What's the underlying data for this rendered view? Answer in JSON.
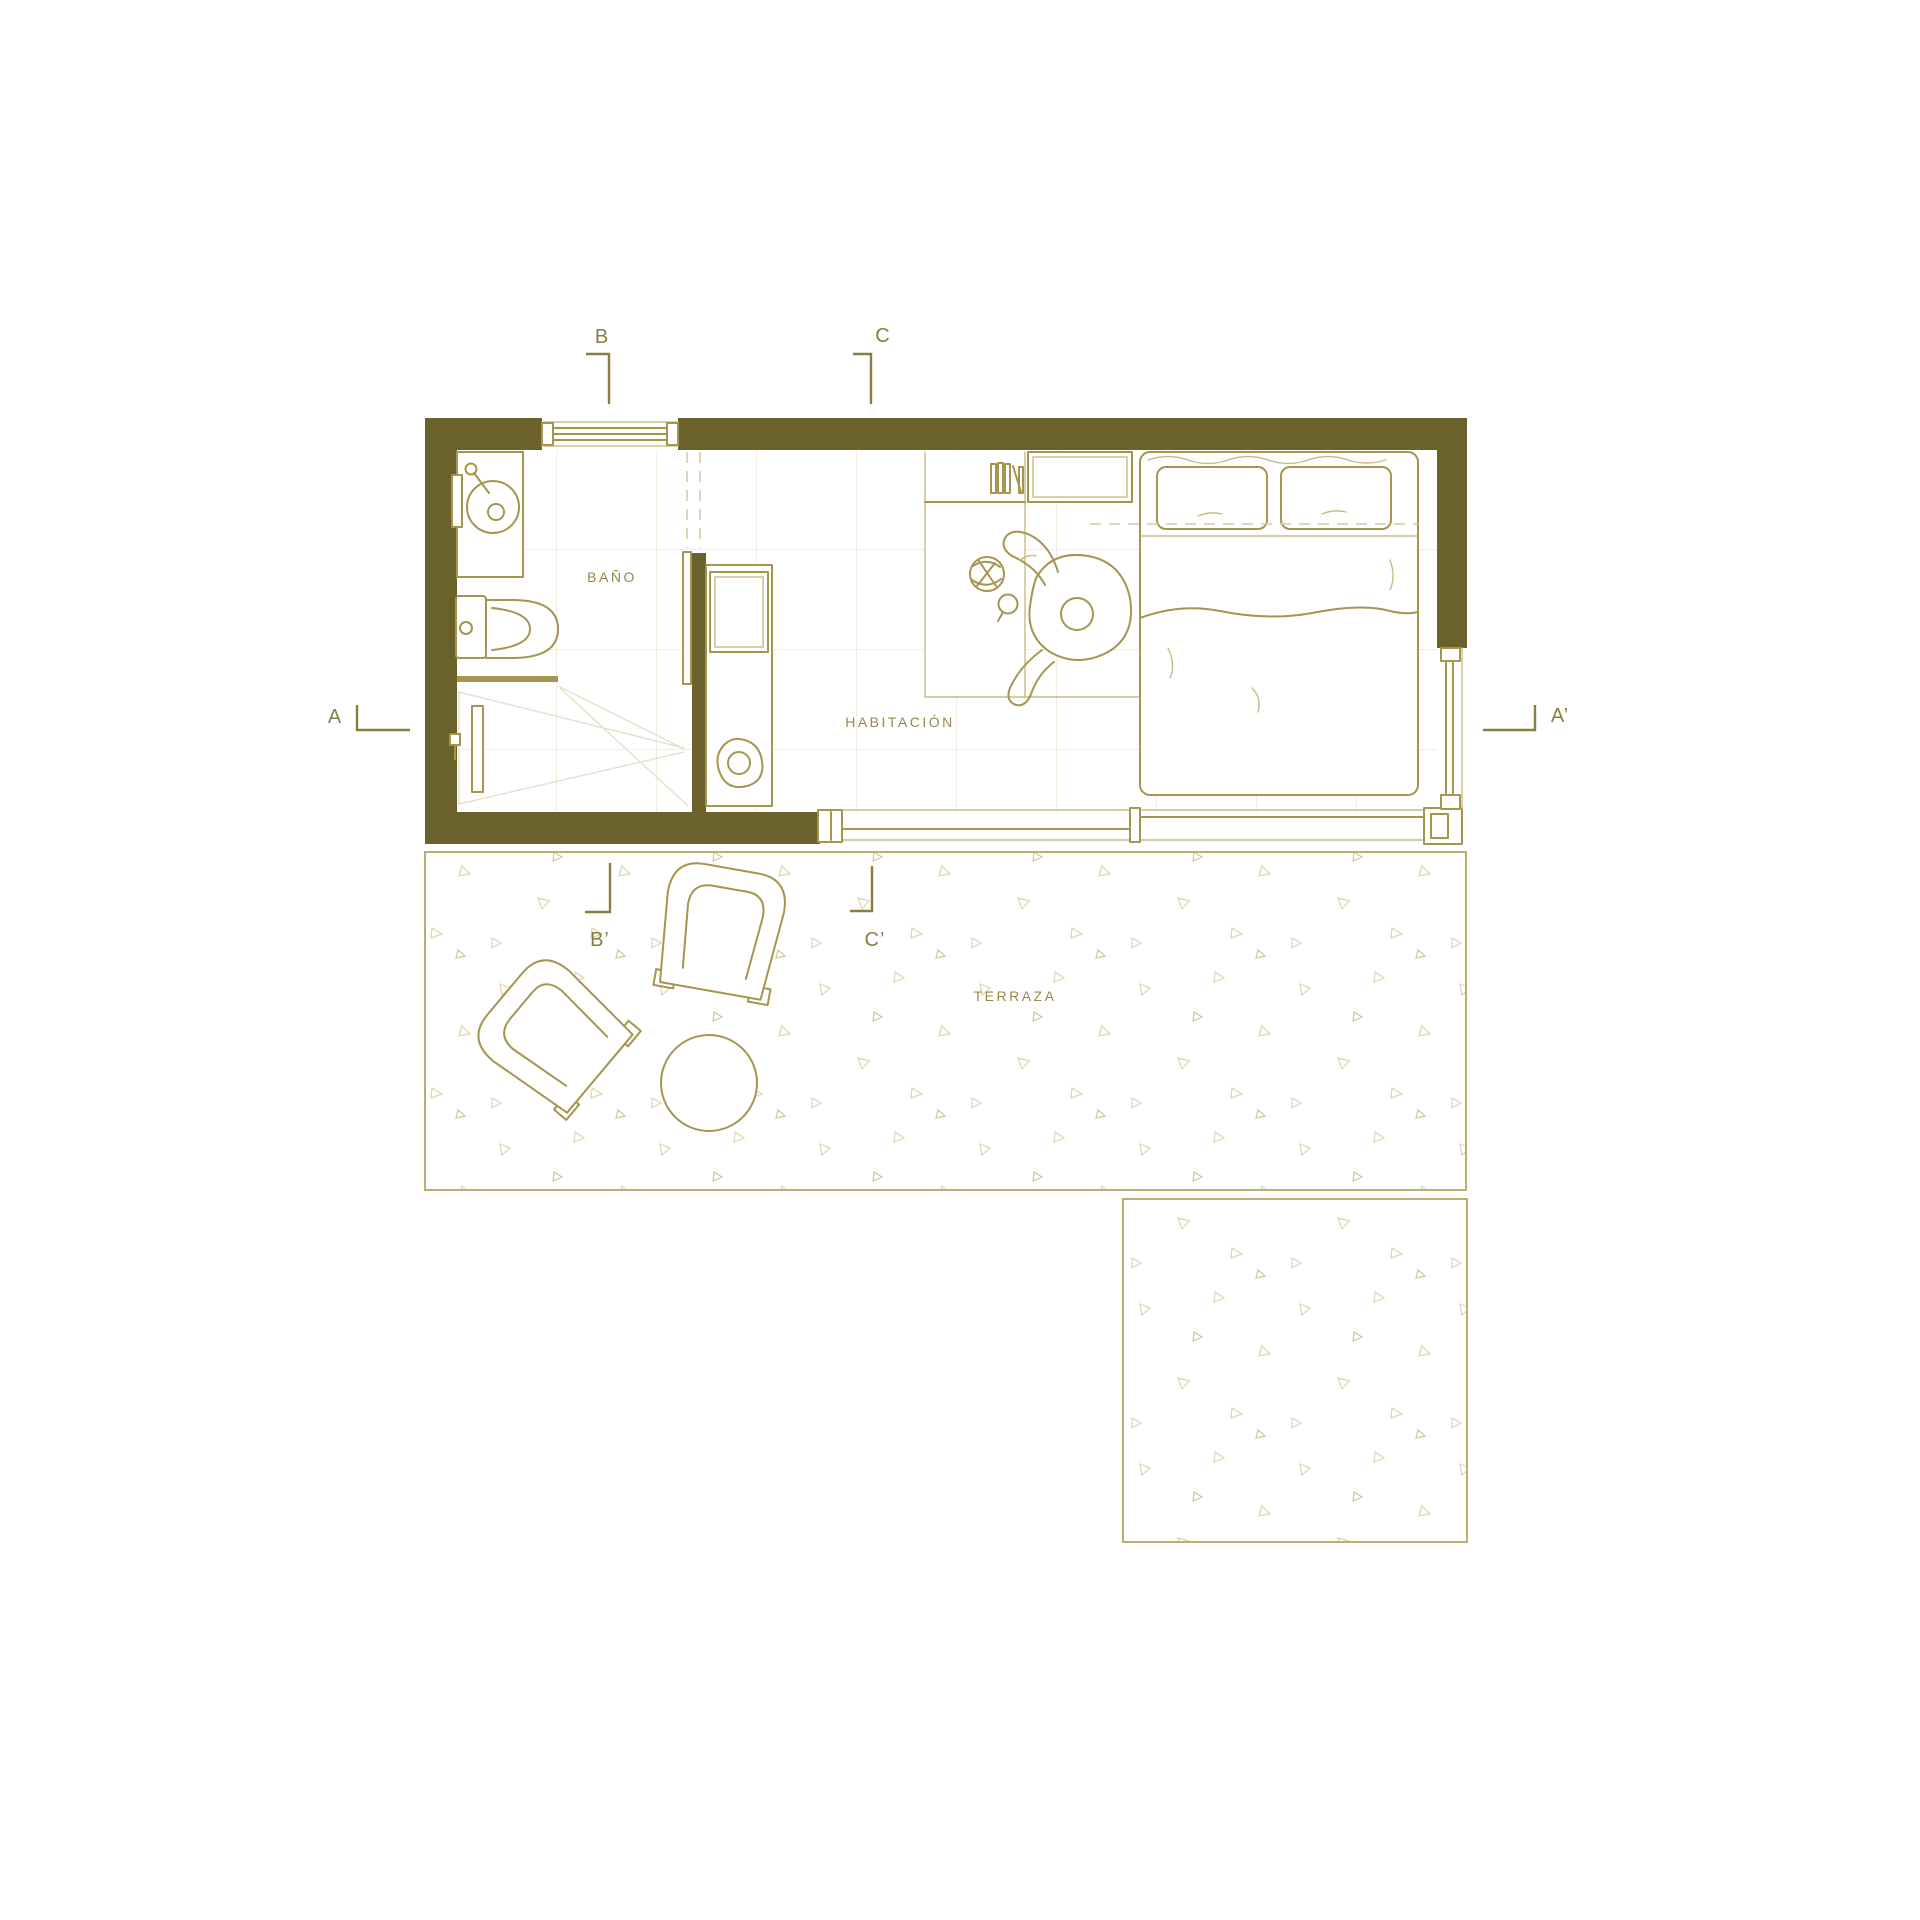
{
  "colors": {
    "bg": "#ffffff",
    "wall": "#6b622b",
    "line": "#a6954e",
    "lightline": "#c9bc85",
    "grid": "#e3dcc0",
    "dash": "#d3cba4",
    "speckle": "#dcd5ab",
    "speckle2": "#cfc693",
    "label": "#97894a",
    "section": "#8a7d42",
    "terrace_border": "#bcae72"
  },
  "labels": {
    "bathroom": "BAÑO",
    "bedroom": "HABITACIÓN",
    "terrace": "TERRAZA"
  },
  "sections": {
    "a": "A",
    "a_prime": "A’",
    "b": "B",
    "b_prime": "B’",
    "c": "C",
    "c_prime": "C’"
  }
}
